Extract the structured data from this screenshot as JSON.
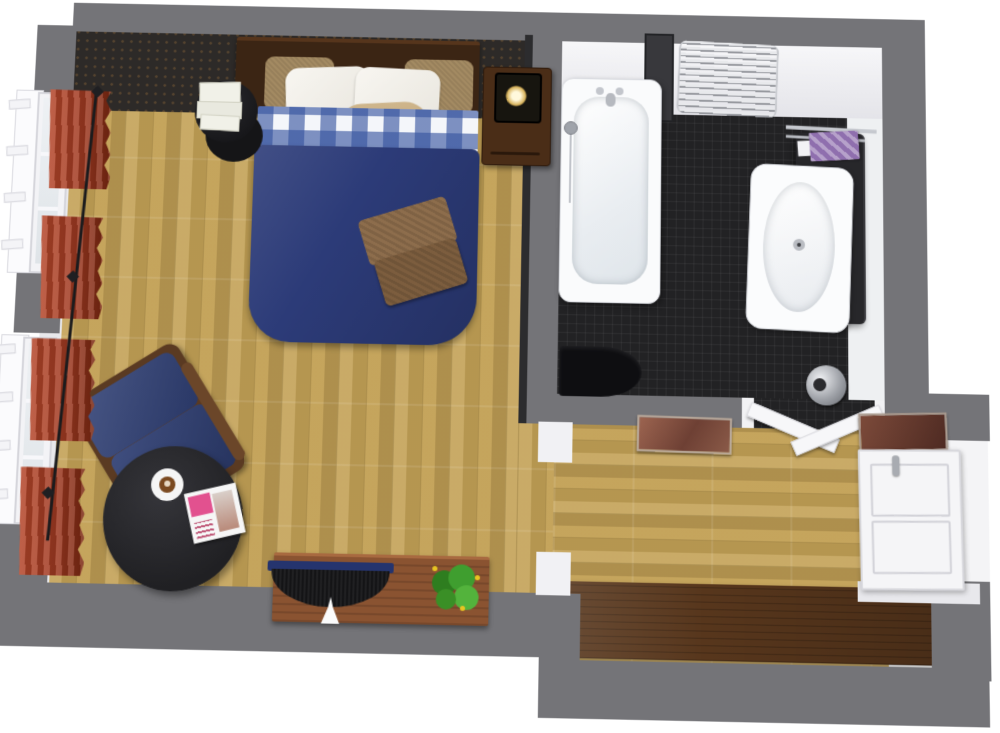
{
  "scene": {
    "title": "3D Floor Plan — Bedroom, Bathroom & Hallway",
    "view": "top-down 3D architectural rendering of a one-bedroom suite",
    "pillow_text_line1": "· MOULIN DE COURAGE ·",
    "pillow_text_line2": "FINEST",
    "rooms": [
      {
        "id": "bedroom",
        "label": "Bedroom",
        "floor": "light oak plank (vertical planks)",
        "items": [
          "double bed with navy duvet and blue gingham sheet",
          "dark walnut headboard with two burlap and two white pillows",
          "burlap bolster pillow with stamped text",
          "folded brown waffle blanket on duvet",
          "wooden nightstand with glowing cube lamp",
          "black round pedestal side table with stack of white books",
          "navy upholstered armchair with wooden arm",
          "black round coffee table with espresso cup and magazine",
          "copper-brown sideboard with flat-screen TV and flowering plant",
          "two tall windows with white frames and rust-red curtains on a black rod",
          "dark patterned accent wall behind the bed"
        ]
      },
      {
        "id": "bathroom",
        "label": "Bathroom",
        "floor": "anthracite mosaic tile",
        "items": [
          "white bathtub with chrome mixer and hand shower",
          "smoked-glass shower screen at tub head",
          "curved chrome towel radiator on top wall",
          "white washbasin on dark vanity cabinet",
          "chrome towel rail with purple towel",
          "black toilet",
          "chrome pedal bin",
          "double doorway to hallway with white door leaves"
        ]
      },
      {
        "id": "hallway",
        "label": "Hallway",
        "floor": "light oak plank (horizontal planks)",
        "items": [
          "dark walnut runner mat",
          "white panelled entry door with chrome handle",
          "two framed artworks above the doorways",
          "open passage to bedroom"
        ]
      }
    ],
    "palette": {
      "outer_wall": "#747478",
      "inner_wall": "#f0f0f3",
      "accent_wall": "#2d2a28",
      "oak_floor": "#c3a156",
      "tile_floor": "#222224",
      "duvet": "#2c3b78",
      "curtain": "#a03a22",
      "armchair": "#2f3f74",
      "runner_mat": "#57361c",
      "sideboard": "#8a5331",
      "plant": "#3f9e2f",
      "towel": "#8f6fae",
      "furniture_wood": "#4a2d17",
      "table_black": "#202023",
      "tub_white": "#fafbfc"
    }
  }
}
